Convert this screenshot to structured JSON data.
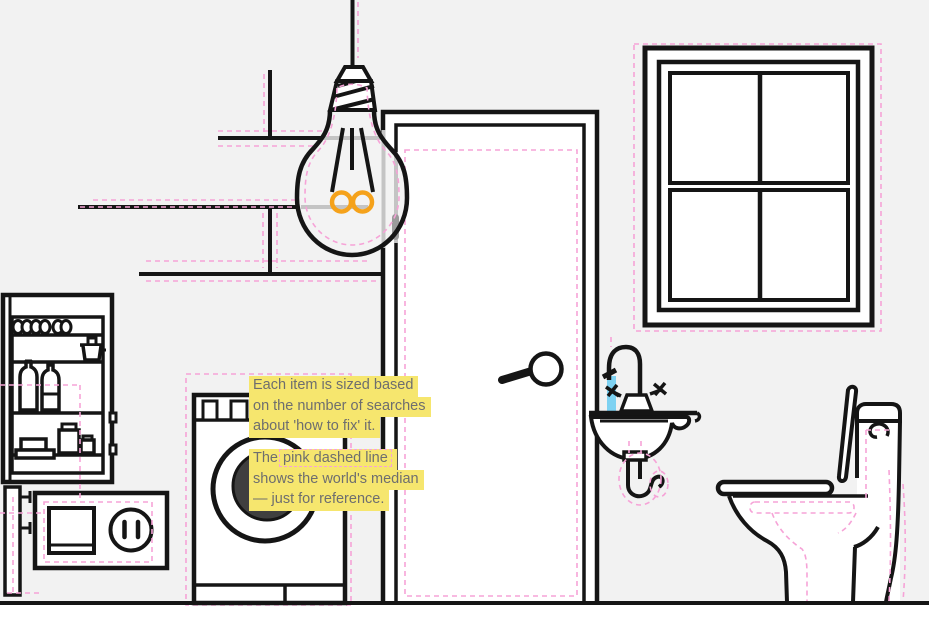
{
  "captions": {
    "sizing": {
      "l1": "Each item is sized based",
      "l2": "on the number of searches",
      "l3": "about 'how to fix' it."
    },
    "median": {
      "prefix": "The",
      "highlight": "pink dashed line",
      "l2": "shows the world's median",
      "l3": "— just for reference."
    }
  },
  "illustration_items": [
    "light-bulb",
    "door",
    "window",
    "washing-machine",
    "refrigerator",
    "power-outlet-and-switch",
    "sink",
    "toilet",
    "wall-shelves",
    "pipe"
  ],
  "colors": {
    "bg": "#f2f2f2",
    "line": "#151515",
    "pink": "#f6a3d7",
    "yellow": "#f6e66e",
    "captext": "#6e6e6e",
    "orange": "#f5a21b",
    "blue": "#7ed2f2",
    "dark": "#3f3f3f",
    "gray": "#c4c4c4",
    "grayDark": "#9b9b9b",
    "white": "#ffffff"
  }
}
